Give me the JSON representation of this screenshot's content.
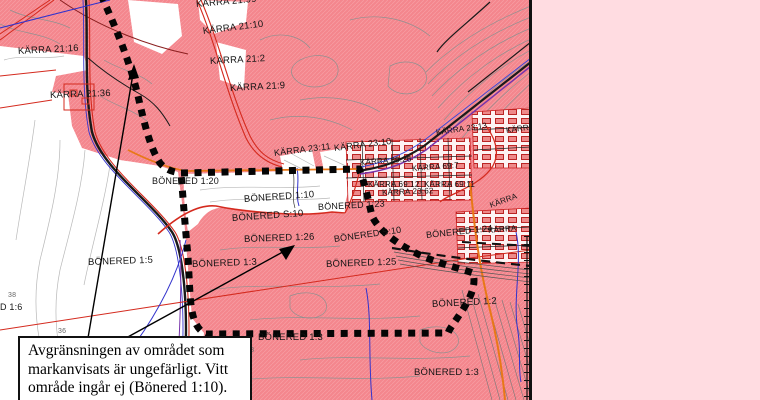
{
  "map": {
    "labels": [
      {
        "text": "KÄRRA 21:16",
        "x": 18,
        "y": 46,
        "rot": -3,
        "size": 9.5,
        "color": "#141414"
      },
      {
        "text": "KÄRRA 21:36",
        "x": 50,
        "y": 90,
        "rot": -2,
        "size": 9.5,
        "color": "#141414"
      },
      {
        "text": "KÄRRA 21:99",
        "x": 196,
        "y": -1,
        "rot": -5,
        "size": 9.5,
        "color": "#141414"
      },
      {
        "text": "KÄRRA 21:10",
        "x": 203,
        "y": 26,
        "rot": -7,
        "size": 9.5,
        "color": "#141414"
      },
      {
        "text": "KÄRRA 21:2",
        "x": 210,
        "y": 56,
        "rot": -3,
        "size": 9.5,
        "color": "#141414"
      },
      {
        "text": "KÄRRA 21:9",
        "x": 230,
        "y": 83,
        "rot": -3,
        "size": 9.5,
        "color": "#141414"
      },
      {
        "text": "KÄRRA 23:11",
        "x": 274,
        "y": 148,
        "rot": -7,
        "size": 9,
        "color": "#141414"
      },
      {
        "text": "KÄRRA 23:10",
        "x": 334,
        "y": 143,
        "rot": -7,
        "size": 9,
        "color": "#141414"
      },
      {
        "text": "KÄRRA 23:13",
        "x": 436,
        "y": 128,
        "rot": -8,
        "size": 8,
        "color": "#141414"
      },
      {
        "text": "KÄRRA",
        "x": 506,
        "y": 126,
        "rot": -8,
        "size": 8,
        "color": "#141414"
      },
      {
        "text": "KÄRRA 69:26",
        "x": 360,
        "y": 158,
        "rot": -4,
        "size": 8,
        "color": "#141414"
      },
      {
        "text": "KÄRRA 69:7",
        "x": 412,
        "y": 164,
        "rot": -4,
        "size": 8,
        "color": "#141414"
      },
      {
        "text": "KÄRRA 69:12",
        "x": 368,
        "y": 180,
        "rot": 0,
        "size": 8,
        "color": "#141414"
      },
      {
        "text": "KÄRRA 69:11",
        "x": 424,
        "y": 180,
        "rot": 0,
        "size": 8,
        "color": "#141414"
      },
      {
        "text": "KÄRRA 23:62",
        "x": 382,
        "y": 188,
        "rot": -2,
        "size": 8,
        "color": "#141414"
      },
      {
        "text": "KÄRRA",
        "x": 490,
        "y": 201,
        "rot": -20,
        "size": 8,
        "color": "#141414"
      },
      {
        "text": "KÄRRA",
        "x": 488,
        "y": 226,
        "rot": -5,
        "size": 8,
        "color": "#141414"
      },
      {
        "text": "BÖNERED 1:20",
        "x": 152,
        "y": 176,
        "rot": 0,
        "size": 9,
        "color": "#141414"
      },
      {
        "text": "BÖNERED 1:10",
        "x": 244,
        "y": 194,
        "rot": -4,
        "size": 9.5,
        "color": "#141414"
      },
      {
        "text": "BÖNERED S:10",
        "x": 232,
        "y": 213,
        "rot": -4,
        "size": 9.5,
        "color": "#141414"
      },
      {
        "text": "BÖNERED 1:26",
        "x": 244,
        "y": 234,
        "rot": -2,
        "size": 9.5,
        "color": "#141414"
      },
      {
        "text": "BÖNERED 1:23",
        "x": 318,
        "y": 202,
        "rot": -3,
        "size": 9,
        "color": "#141414"
      },
      {
        "text": "BÖNERED S:10",
        "x": 334,
        "y": 234,
        "rot": -8,
        "size": 9,
        "color": "#141414"
      },
      {
        "text": "BÖNERED 1:24",
        "x": 426,
        "y": 230,
        "rot": -6,
        "size": 9,
        "color": "#141414"
      },
      {
        "text": "BÖNERED 1:5",
        "x": 88,
        "y": 257,
        "rot": -2,
        "size": 9.5,
        "color": "#141414"
      },
      {
        "text": "BÖNERED 1:3",
        "x": 192,
        "y": 259,
        "rot": -2,
        "size": 9.5,
        "color": "#141414"
      },
      {
        "text": "BÖNERED 1:25",
        "x": 326,
        "y": 259,
        "rot": -2,
        "size": 9.5,
        "color": "#141414"
      },
      {
        "text": "BÖNERED 1:2",
        "x": 432,
        "y": 299,
        "rot": -3,
        "size": 9.5,
        "color": "#141414"
      },
      {
        "text": "BÖNERED 1:3",
        "x": 258,
        "y": 332,
        "rot": 0,
        "size": 9.5,
        "color": "#141414"
      },
      {
        "text": "BÖNERED 1:3",
        "x": 414,
        "y": 367,
        "rot": 0,
        "size": 9.5,
        "color": "#141414"
      },
      {
        "text": "D 1:6",
        "x": 0,
        "y": 302,
        "rot": 0,
        "size": 9,
        "color": "#141414"
      },
      {
        "text": "38",
        "x": 8,
        "y": 292,
        "rot": 0,
        "size": 7,
        "color": "#666666"
      },
      {
        "text": "36",
        "x": 58,
        "y": 328,
        "rot": 0,
        "size": 7,
        "color": "#666666"
      },
      {
        "text": "28",
        "x": 246,
        "y": 347,
        "rot": 0,
        "size": 7,
        "color": "#666666"
      }
    ]
  },
  "note": {
    "lines": [
      "Avgränsningen av området som",
      "markanvisats är ungefärligt. Vitt",
      "område ingår ej (Bönered 1:10)."
    ]
  },
  "colors": {
    "map_pink": "#f4868d",
    "panel_pink": "#ffdce1",
    "parcel_red": "#d42a1e",
    "water_blue": "#3333cc",
    "cable_purple": "#7733aa",
    "route_orange": "#e87817",
    "contour_gray": "#909090",
    "boundary_black": "#050505"
  }
}
